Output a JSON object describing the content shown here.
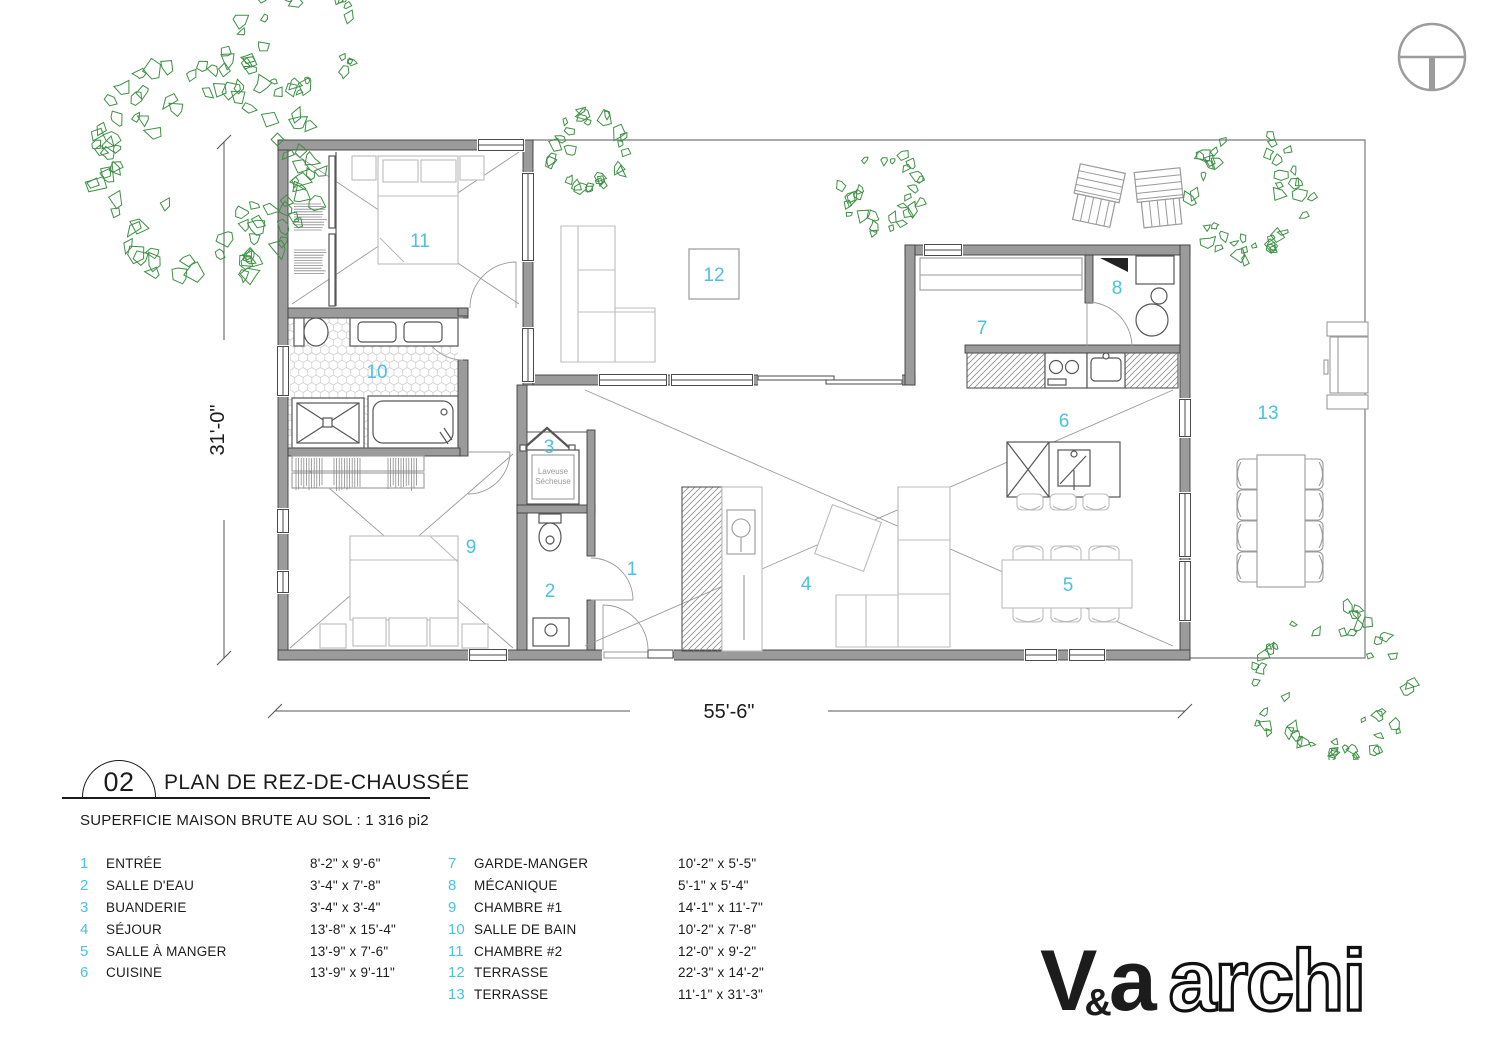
{
  "title_block": {
    "number": "02",
    "title": "PLAN DE REZ-DE-CHAUSSÉE",
    "area_note": "SUPERFICIE MAISON BRUTE AU SOL : 1 316 pi2"
  },
  "plan": {
    "numbers": [
      "1",
      "2",
      "3",
      "4",
      "5",
      "6",
      "7",
      "8",
      "9",
      "10",
      "11",
      "12",
      "13"
    ],
    "washer_label_line1": "Laveuse",
    "washer_label_line2": "Sécheuse",
    "dim_bottom": "55'-6\"",
    "dim_left": "31'-0\"",
    "colors": {
      "accent": "#49c2e3",
      "wall": "#9b9b9b",
      "tree": "#3d9144"
    }
  },
  "legend": {
    "left": [
      {
        "num": "1",
        "name": "ENTRÉE",
        "size": "8'-2\" x 9'-6\""
      },
      {
        "num": "2",
        "name": "SALLE D'EAU",
        "size": "3'-4\" x 7'-8\""
      },
      {
        "num": "3",
        "name": "BUANDERIE",
        "size": "3'-4\" x 3'-4\""
      },
      {
        "num": "4",
        "name": "SÉJOUR",
        "size": "13'-8\" x 15'-4\""
      },
      {
        "num": "5",
        "name": "SALLE À MANGER",
        "size": "13'-9\" x 7'-6\""
      },
      {
        "num": "6",
        "name": "CUISINE",
        "size": "13'-9\" x 9'-11\""
      }
    ],
    "right": [
      {
        "num": "7",
        "name": "GARDE-MANGER",
        "size": "10'-2\" x 5'-5\""
      },
      {
        "num": "8",
        "name": "MÉCANIQUE",
        "size": "5'-1\" x 5'-4\""
      },
      {
        "num": "9",
        "name": "CHAMBRE #1",
        "size": "14'-1\" x 11'-7\""
      },
      {
        "num": "10",
        "name": "SALLE DE BAIN",
        "size": "10'-2\" x 7'-8\""
      },
      {
        "num": "11",
        "name": "CHAMBRE #2",
        "size": "12'-0\" x 9'-2\""
      },
      {
        "num": "12",
        "name": "TERRASSE",
        "size": "22'-3\" x 14'-2\""
      },
      {
        "num": "13",
        "name": "TERRASSE",
        "size": "11'-1\" x 31'-3\""
      }
    ]
  },
  "logo": {
    "v": "V",
    "amp": "&",
    "a": "a",
    "suffix": "archi"
  }
}
